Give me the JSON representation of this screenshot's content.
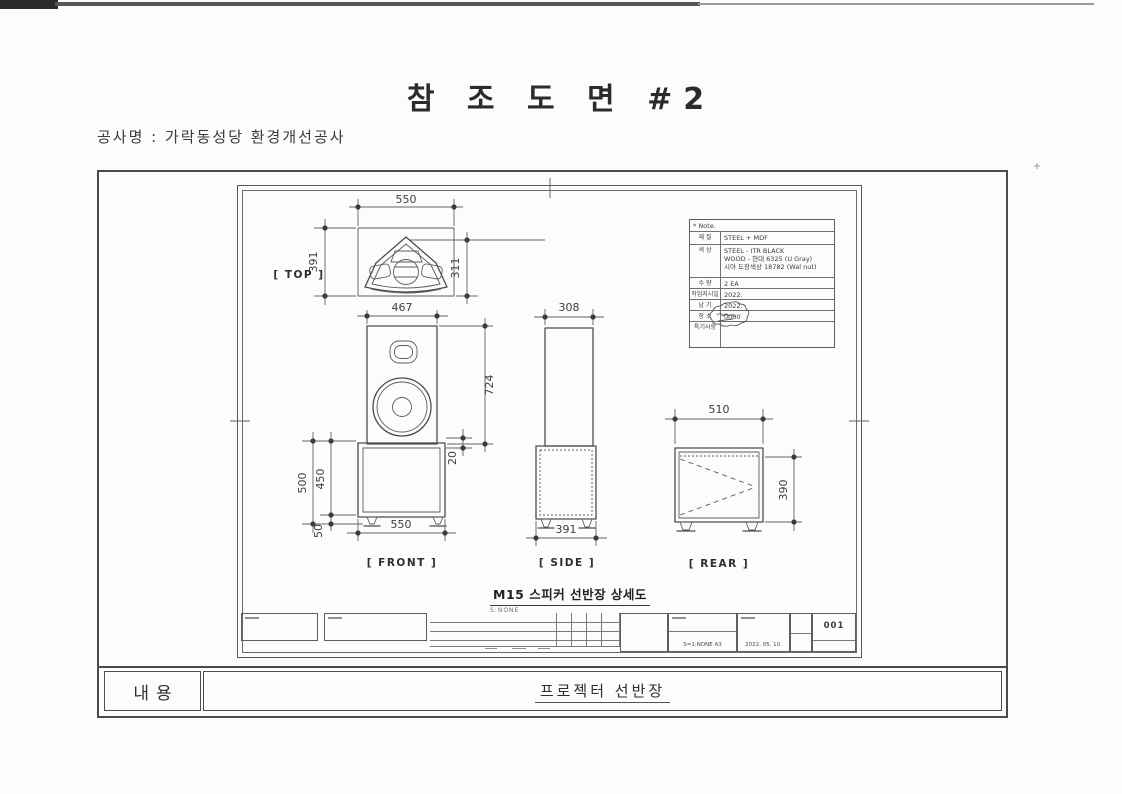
{
  "colors": {
    "paper": "#fcfcfb",
    "line": "#4c4c4c",
    "ink": "#2b2b2b"
  },
  "header": {
    "title": "참 조 도 면 #2",
    "project": "공사명 : 가락동성당 환경개선공사"
  },
  "notes": {
    "header": "* Note.",
    "rows": [
      {
        "label": "재 질",
        "value": "STEEL + MDF"
      },
      {
        "label": "색 상",
        "line1": "STEEL - ITR BLACK",
        "line2": "WOOD - 현대 6325 (U Gray)",
        "line3": "시아 도장색상 18782 (Wal nut)"
      },
      {
        "label": "수 량",
        "value": "2 EA"
      },
      {
        "label": "작업지시일",
        "value": "2022."
      },
      {
        "label": "납 기",
        "value": "2022."
      },
      {
        "label": "장 소",
        "value": "0000"
      },
      {
        "label": "특기사항",
        "value": ""
      }
    ]
  },
  "views": {
    "top": {
      "label": "[ TOP ]",
      "width": "550",
      "height_left": "391",
      "height_right": "311"
    },
    "front": {
      "label": "[ FRONT ]",
      "speaker_width": "467",
      "speaker_height": "724",
      "rim": "20",
      "total_height": "500",
      "cabinet_height": "450",
      "foot_height": "50",
      "cabinet_width": "550"
    },
    "side": {
      "label": "[ SIDE ]",
      "top_width": "308",
      "bottom_width": "391"
    },
    "rear": {
      "label": "[ REAR ]",
      "width": "510",
      "height": "390"
    }
  },
  "drawing": {
    "title": "M15 스피커 선반장 상세도",
    "scale": "S:NONE"
  },
  "titleblock": {
    "scale_size": "S=1:NONE   A3",
    "date": "2022. 05. 10.",
    "sheet_no": "001"
  },
  "footer": {
    "label": "내용",
    "value": "프로젝터 선반장"
  }
}
